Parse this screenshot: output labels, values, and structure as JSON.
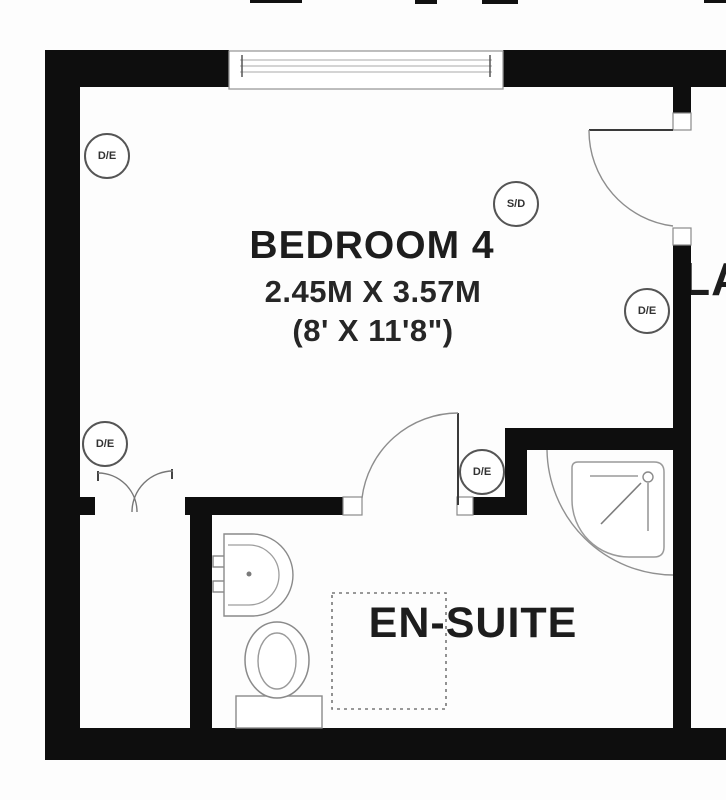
{
  "rooms": {
    "bedroom": {
      "name": "BEDROOM 4",
      "dimensions_metric": "2.45M X 3.57M",
      "dimensions_imperial": "(8' X 11'8\")"
    },
    "ensuite": {
      "name": "EN-SUITE"
    },
    "landing": {
      "name": "LANDING"
    }
  },
  "markers": [
    {
      "label": "D/E"
    },
    {
      "label": "S/D"
    },
    {
      "label": "D/E"
    },
    {
      "label": "D/E"
    },
    {
      "label": "D/E"
    }
  ],
  "fixtures": {
    "window": "window",
    "entry_door": "single-door",
    "ensuite_door": "single-door",
    "wardrobe_doors": "double-door",
    "shower": "quadrant-shower",
    "basin": "wash-basin",
    "toilet": "toilet",
    "cupboard_outline": "dashed-rectangle"
  },
  "colors": {
    "wall": "#0e0e0e",
    "fixture_line": "#888888",
    "text": "#1d1d1d",
    "background": "#fdfdfd"
  }
}
